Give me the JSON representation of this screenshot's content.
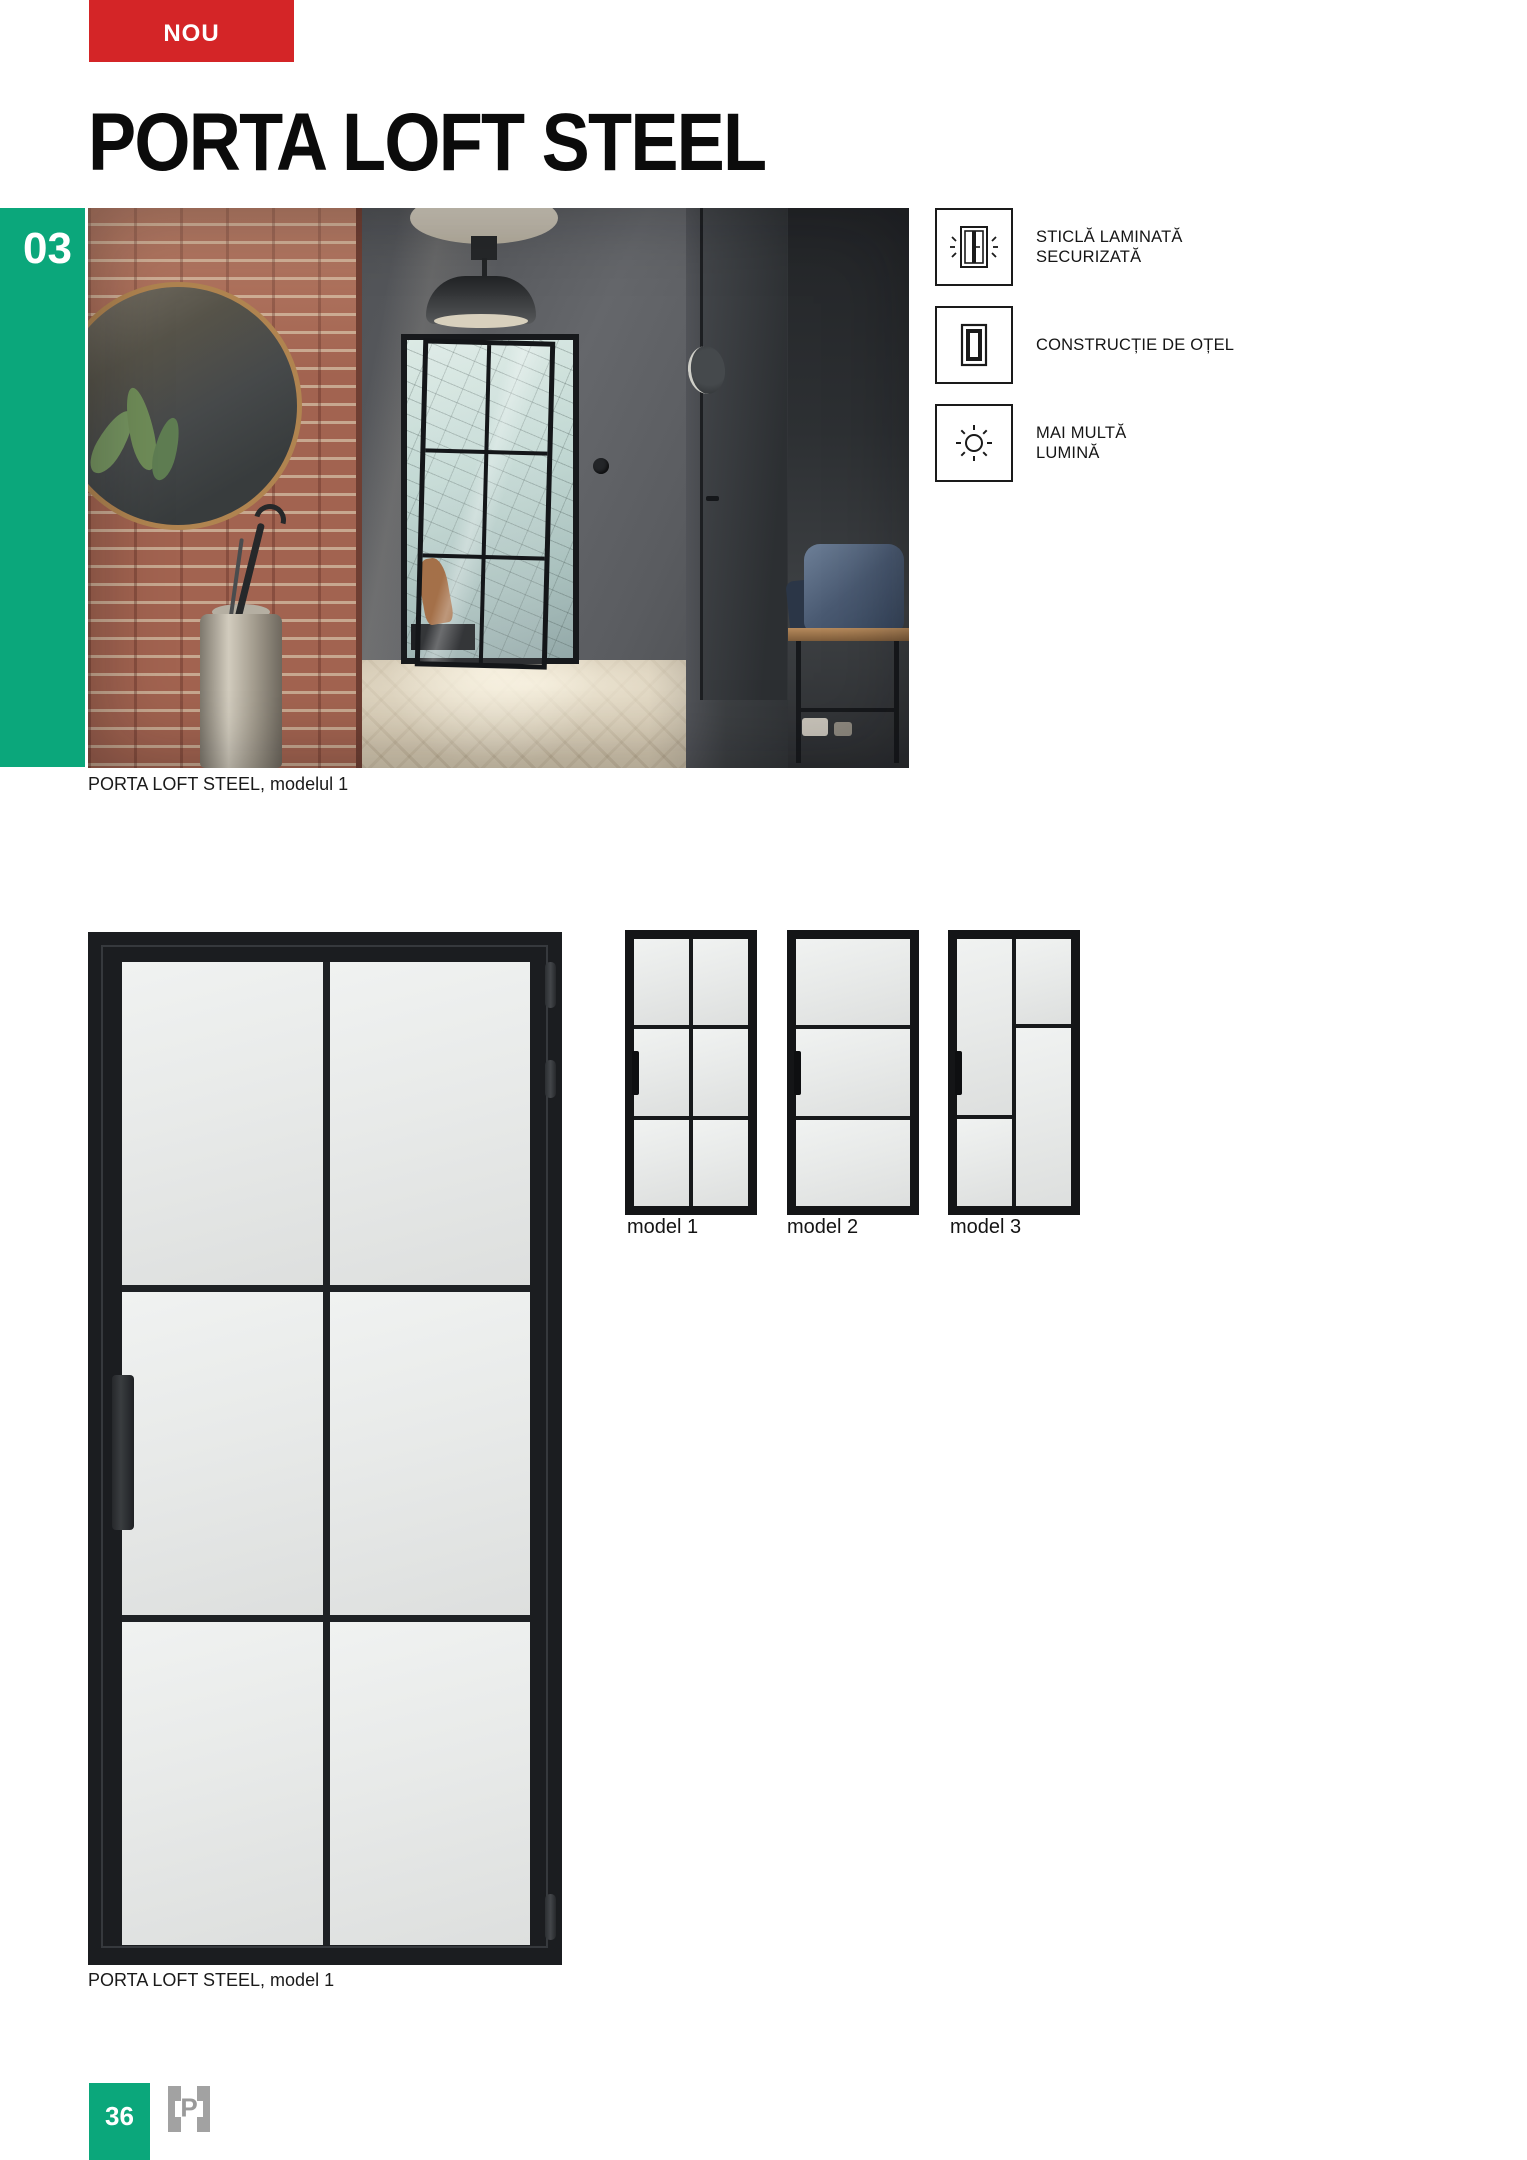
{
  "badge": {
    "label": "NOU"
  },
  "header": {
    "title": "PORTA LOFT STEEL"
  },
  "sidebar": {
    "section_number": "03"
  },
  "photo": {
    "caption": "PORTA LOFT STEEL, modelul 1"
  },
  "features": [
    {
      "icon": "laminated-glass-icon",
      "line1": "STICLĂ LAMINATĂ",
      "line2": "SECURIZATĂ"
    },
    {
      "icon": "steel-frame-icon",
      "line1": "CONSTRUCȚIE DE OȚEL",
      "line2": ""
    },
    {
      "icon": "sun-icon",
      "line1": "MAI MULTĂ",
      "line2": "LUMINĂ"
    }
  ],
  "diagram": {
    "caption": "PORTA LOFT STEEL, model 1"
  },
  "models": [
    {
      "label": "model 1",
      "layout": "2 columns x 3 rows glazing"
    },
    {
      "label": "model 2",
      "layout": "3 horizontal glazing rows"
    },
    {
      "label": "model 3",
      "layout": "asymmetric 2-column glazing"
    }
  ],
  "footer": {
    "page_number": "36",
    "logo_letter": "P"
  },
  "colors": {
    "accent_green": "#0ba77b",
    "badge_red": "#d42527",
    "logo_gray": "#9e9e9e",
    "door_black": "#1b1d20"
  }
}
